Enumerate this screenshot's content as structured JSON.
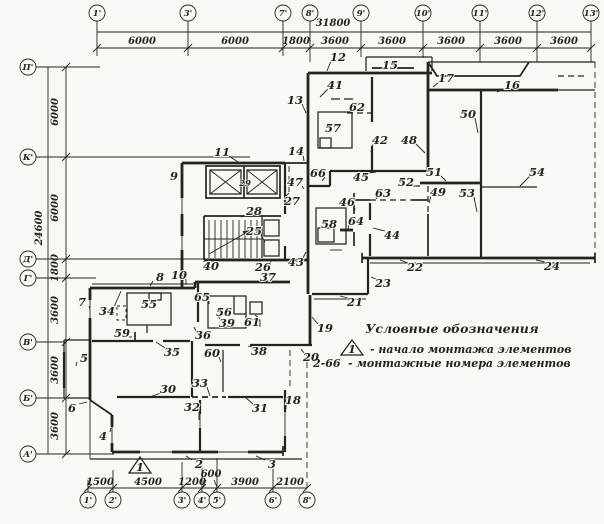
{
  "legend": {
    "title": "Условные обозначения",
    "start_symbol": "1",
    "start_text": "- начало монтажа элементов",
    "range_symbol": "2-66",
    "range_text": "- монтажные номера элементов"
  },
  "start_marker": {
    "label": "1"
  },
  "colors": {
    "ink": "#26221c",
    "paper": "#f9f8f4"
  },
  "axes": {
    "top": {
      "total": {
        "text": "31800",
        "x": 333,
        "y": 26
      },
      "circle_y": 13,
      "columns": [
        {
          "label": "1'",
          "x": 97
        },
        {
          "label": "3'",
          "x": 188
        },
        {
          "label": "7'",
          "x": 283
        },
        {
          "label": "8'",
          "x": 310
        },
        {
          "label": "9'",
          "x": 361
        },
        {
          "label": "10'",
          "x": 423
        },
        {
          "label": "11'",
          "x": 480
        },
        {
          "label": "12'",
          "x": 537
        },
        {
          "label": "13'",
          "x": 591
        }
      ],
      "dims": [
        {
          "text": "6000",
          "x": 142
        },
        {
          "text": "6000",
          "x": 235
        },
        {
          "text": "1800",
          "x": 296
        },
        {
          "text": "3600",
          "x": 335
        },
        {
          "text": "3600",
          "x": 392
        },
        {
          "text": "3600",
          "x": 451
        },
        {
          "text": "3600",
          "x": 508
        },
        {
          "text": "3600",
          "x": 564
        }
      ]
    },
    "left": {
      "total": {
        "text": "24600",
        "x": 42,
        "y": 228
      },
      "circle_x": 28,
      "rows": [
        {
          "label": "П'",
          "y": 67
        },
        {
          "label": "К'",
          "y": 157
        },
        {
          "label": "Д'",
          "y": 259
        },
        {
          "label": "Г'",
          "y": 278
        },
        {
          "label": "В'",
          "y": 342
        },
        {
          "label": "Б'",
          "y": 398
        },
        {
          "label": "А'",
          "y": 454
        }
      ],
      "dims": [
        {
          "text": "6000",
          "y": 112
        },
        {
          "text": "6000",
          "y": 208
        },
        {
          "text": "1800",
          "y": 268
        },
        {
          "text": "3600",
          "y": 310
        },
        {
          "text": "3600",
          "y": 370
        },
        {
          "text": "3600",
          "y": 426
        }
      ]
    },
    "bottom": {
      "circle_y": 500,
      "columns": [
        {
          "label": "1'",
          "x": 88
        },
        {
          "label": "2'",
          "x": 113
        },
        {
          "label": "3'",
          "x": 182
        },
        {
          "label": "4'",
          "x": 202
        },
        {
          "label": "5'",
          "x": 217
        },
        {
          "label": "6'",
          "x": 273
        },
        {
          "label": "8'",
          "x": 307
        }
      ],
      "dims": [
        {
          "text": "1500",
          "x": 100,
          "y": 485
        },
        {
          "text": "4500",
          "x": 148,
          "y": 485
        },
        {
          "text": "1200",
          "x": 192,
          "y": 485
        },
        {
          "text": "600",
          "x": 211,
          "y": 477
        },
        {
          "text": "3900",
          "x": 245,
          "y": 485
        },
        {
          "text": "2100",
          "x": 290,
          "y": 485
        }
      ]
    }
  },
  "montage_numbers": [
    {
      "n": "2",
      "x": 199,
      "y": 464,
      "lx": 186,
      "ly": 456
    },
    {
      "n": "3",
      "x": 272,
      "y": 464,
      "lx": 256,
      "ly": 456
    },
    {
      "n": "4",
      "x": 103,
      "y": 436,
      "lx": 111,
      "ly": 428
    },
    {
      "n": "5",
      "x": 84,
      "y": 358,
      "lx": 76,
      "ly": 366
    },
    {
      "n": "6",
      "x": 72,
      "y": 408,
      "lx": 87,
      "ly": 402
    },
    {
      "n": "7",
      "x": 82,
      "y": 302,
      "lx": 90,
      "ly": 309
    },
    {
      "n": "8",
      "x": 160,
      "y": 277,
      "lx": 150,
      "ly": 286
    },
    {
      "n": "9",
      "x": 174,
      "y": 176,
      "lx": 182,
      "ly": 188
    },
    {
      "n": "10",
      "x": 179,
      "y": 275,
      "lx": 186,
      "ly": 285
    },
    {
      "n": "11",
      "x": 222,
      "y": 152,
      "lx": 238,
      "ly": 162
    },
    {
      "n": "12",
      "x": 338,
      "y": 57,
      "lx": 327,
      "ly": 71
    },
    {
      "n": "13",
      "x": 295,
      "y": 100,
      "lx": 306,
      "ly": 113
    },
    {
      "n": "14",
      "x": 296,
      "y": 151,
      "lx": 304,
      "ly": 161
    },
    {
      "n": "15",
      "x": 390,
      "y": 65
    },
    {
      "n": "16",
      "x": 512,
      "y": 85,
      "lx": 497,
      "ly": 92
    },
    {
      "n": "17",
      "x": 446,
      "y": 78,
      "lx": 433,
      "ly": 87
    },
    {
      "n": "18",
      "x": 293,
      "y": 400,
      "lx": 286,
      "ly": 409
    },
    {
      "n": "19",
      "x": 325,
      "y": 328,
      "lx": 312,
      "ly": 317
    },
    {
      "n": "20",
      "x": 311,
      "y": 357,
      "lx": 301,
      "ly": 349
    },
    {
      "n": "21",
      "x": 355,
      "y": 302,
      "lx": 340,
      "ly": 296
    },
    {
      "n": "22",
      "x": 415,
      "y": 267,
      "lx": 400,
      "ly": 260
    },
    {
      "n": "23",
      "x": 383,
      "y": 283,
      "lx": 371,
      "ly": 277
    },
    {
      "n": "24",
      "x": 552,
      "y": 266,
      "lx": 536,
      "ly": 260
    },
    {
      "n": "25",
      "x": 254,
      "y": 231,
      "lx": 265,
      "ly": 242
    },
    {
      "n": "26",
      "x": 263,
      "y": 267,
      "lx": 271,
      "ly": 261
    },
    {
      "n": "27",
      "x": 292,
      "y": 201,
      "lx": 289,
      "ly": 193
    },
    {
      "n": "28",
      "x": 254,
      "y": 211,
      "lx": 241,
      "ly": 217
    },
    {
      "n": "29",
      "x": 245,
      "y": 182,
      "small": true
    },
    {
      "n": "30",
      "x": 168,
      "y": 389,
      "lx": 152,
      "ly": 396
    },
    {
      "n": "31",
      "x": 260,
      "y": 408,
      "lx": 246,
      "ly": 398
    },
    {
      "n": "32",
      "x": 192,
      "y": 407,
      "lx": 199,
      "ly": 420
    },
    {
      "n": "33",
      "x": 200,
      "y": 383,
      "lx": 210,
      "ly": 396
    },
    {
      "n": "34",
      "x": 107,
      "y": 311,
      "lx": 121,
      "ly": 291
    },
    {
      "n": "35",
      "x": 172,
      "y": 352,
      "lx": 156,
      "ly": 342
    },
    {
      "n": "36",
      "x": 203,
      "y": 335,
      "lx": 194,
      "ly": 327
    },
    {
      "n": "37",
      "x": 268,
      "y": 277,
      "lx": 280,
      "ly": 282
    },
    {
      "n": "38",
      "x": 259,
      "y": 351,
      "lx": 248,
      "ly": 346
    },
    {
      "n": "39",
      "x": 227,
      "y": 323,
      "lx": 217,
      "ly": 315
    },
    {
      "n": "40",
      "x": 211,
      "y": 266,
      "lx": 204,
      "ly": 261
    },
    {
      "n": "41",
      "x": 335,
      "y": 85,
      "lx": 320,
      "ly": 97
    },
    {
      "n": "42",
      "x": 380,
      "y": 140,
      "lx": 371,
      "ly": 152
    },
    {
      "n": "43",
      "x": 296,
      "y": 262,
      "lx": 306,
      "ly": 252
    },
    {
      "n": "44",
      "x": 392,
      "y": 235,
      "lx": 373,
      "ly": 228
    },
    {
      "n": "45",
      "x": 361,
      "y": 177,
      "lx": 376,
      "ly": 172
    },
    {
      "n": "46",
      "x": 347,
      "y": 202,
      "lx": 355,
      "ly": 210
    },
    {
      "n": "47",
      "x": 295,
      "y": 182,
      "lx": 304,
      "ly": 189
    },
    {
      "n": "48",
      "x": 409,
      "y": 140,
      "lx": 425,
      "ly": 153
    },
    {
      "n": "49",
      "x": 438,
      "y": 192,
      "lx": 429,
      "ly": 203
    },
    {
      "n": "50",
      "x": 468,
      "y": 114,
      "lx": 478,
      "ly": 133
    },
    {
      "n": "51",
      "x": 434,
      "y": 172,
      "lx": 446,
      "ly": 181
    },
    {
      "n": "52",
      "x": 406,
      "y": 182,
      "lx": 419,
      "ly": 186
    },
    {
      "n": "53",
      "x": 467,
      "y": 193,
      "lx": 477,
      "ly": 212
    },
    {
      "n": "54",
      "x": 537,
      "y": 172,
      "lx": 520,
      "ly": 186
    },
    {
      "n": "55",
      "x": 149,
      "y": 304
    },
    {
      "n": "56",
      "x": 224,
      "y": 312
    },
    {
      "n": "57",
      "x": 333,
      "y": 128
    },
    {
      "n": "58",
      "x": 329,
      "y": 224
    },
    {
      "n": "59",
      "x": 122,
      "y": 333,
      "lx": 132,
      "ly": 337
    },
    {
      "n": "60",
      "x": 212,
      "y": 353,
      "lx": 221,
      "ly": 362
    },
    {
      "n": "61",
      "x": 252,
      "y": 322,
      "lx": 255,
      "ly": 315
    },
    {
      "n": "62",
      "x": 357,
      "y": 107,
      "lx": 350,
      "ly": 112
    },
    {
      "n": "63",
      "x": 383,
      "y": 193,
      "lx": 377,
      "ly": 199
    },
    {
      "n": "64",
      "x": 356,
      "y": 221,
      "lx": 348,
      "ly": 229
    },
    {
      "n": "65",
      "x": 202,
      "y": 297,
      "lx": 209,
      "ly": 304
    },
    {
      "n": "66",
      "x": 318,
      "y": 173,
      "lx": 322,
      "ly": 181
    }
  ]
}
